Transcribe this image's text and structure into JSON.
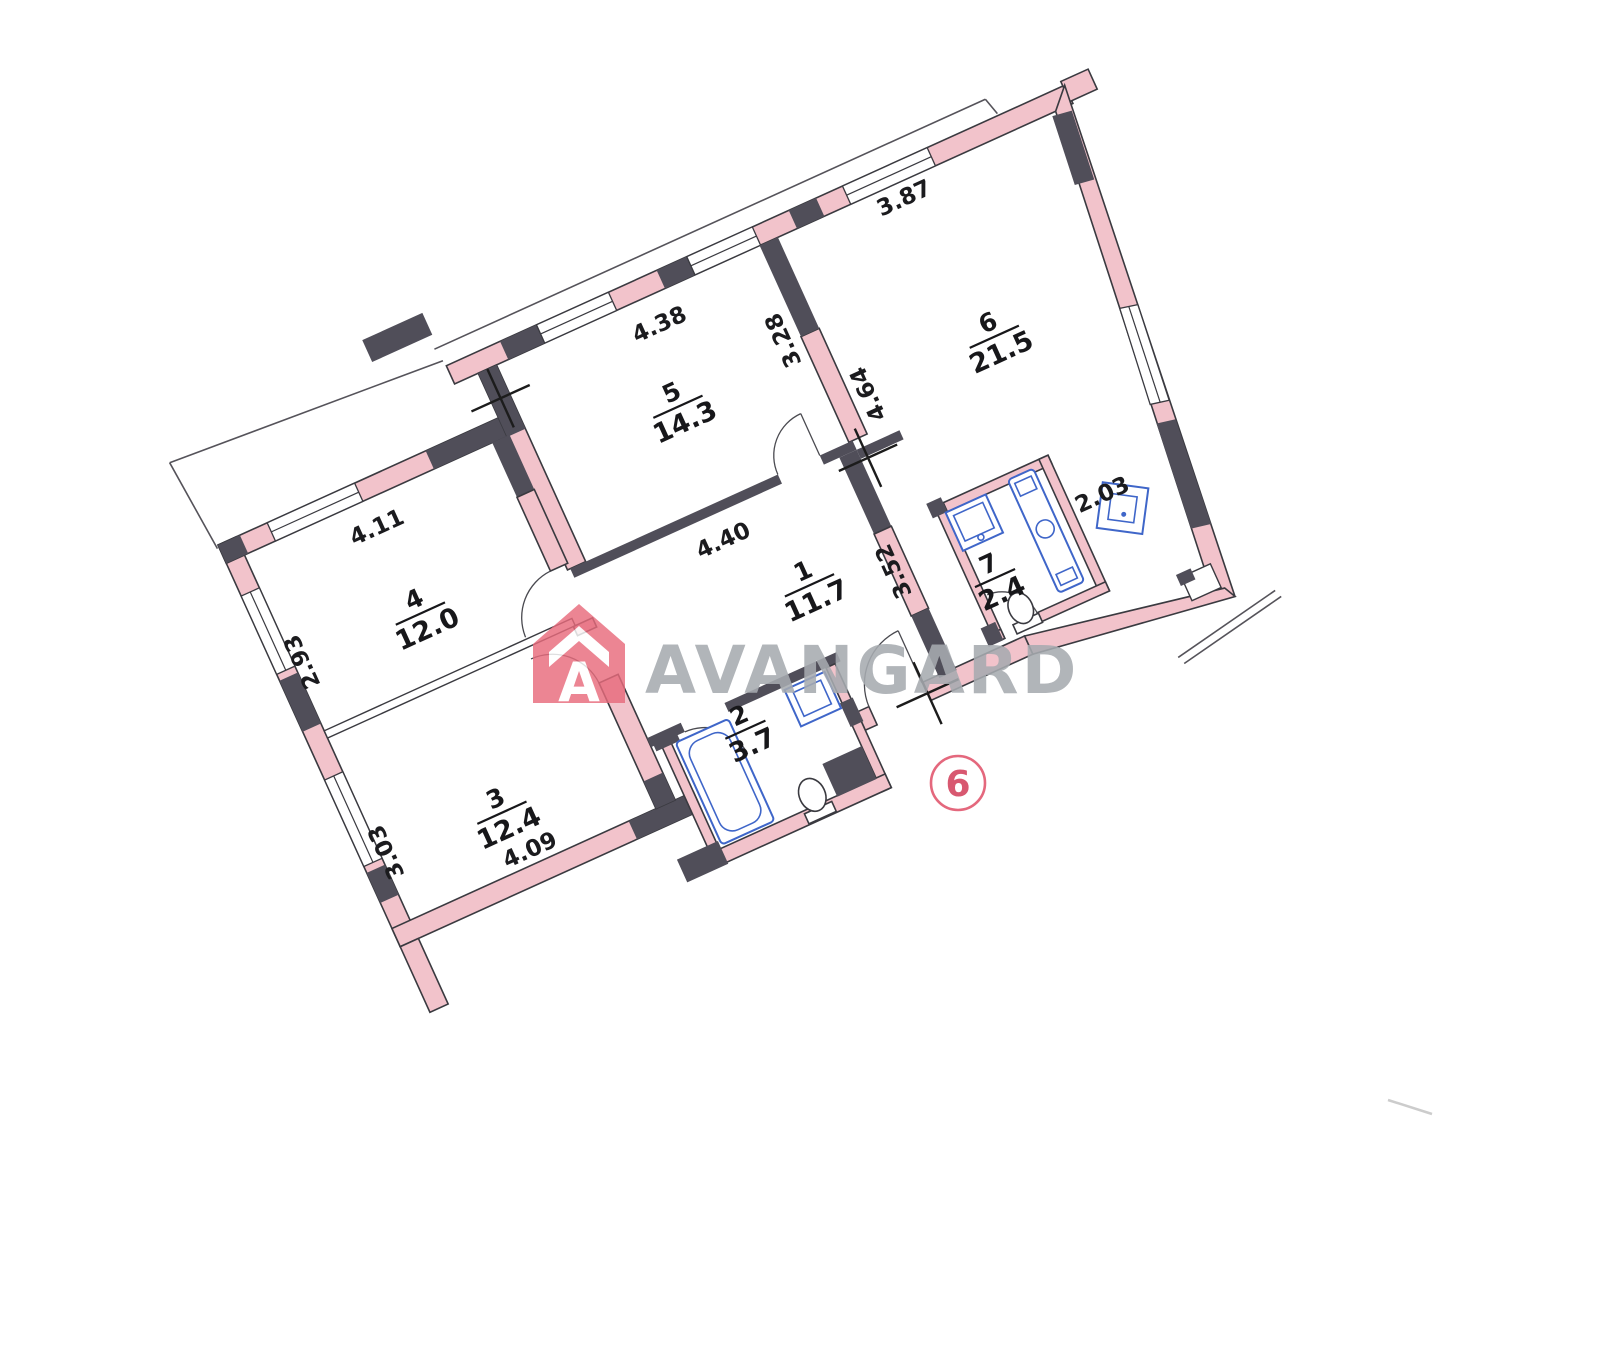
{
  "plan": {
    "rooms": [
      {
        "number": "1",
        "area": "11.7"
      },
      {
        "number": "2",
        "area": "3.7"
      },
      {
        "number": "3",
        "area": "12.4"
      },
      {
        "number": "4",
        "area": "12.0"
      },
      {
        "number": "5",
        "area": "14.3"
      },
      {
        "number": "6",
        "area": "21.5"
      },
      {
        "number": "7",
        "area": "2.4"
      }
    ],
    "dims": {
      "room5_top": "4.38",
      "room6_top": "3.87",
      "room4_top": "4.11",
      "room1_top": "4.40",
      "room3_bottom": "4.09",
      "corridor": "2.03",
      "room4_left": "2.93",
      "room3_left": "3.03",
      "room5_right": "3.28",
      "room6_left": "4.64",
      "hall_right": "3.52"
    },
    "marker": {
      "label": "6"
    }
  },
  "watermark": {
    "text": "AVANGARD",
    "logo_letter": "A"
  },
  "colors": {
    "wall_fill": "#f2c3cb",
    "wall_dark": "#504e59",
    "fixture_blue": "#3f66c9",
    "marker_red": "#e4687d",
    "watermark_gray": "#a7abb0",
    "logo_red": "#e86b7c"
  }
}
